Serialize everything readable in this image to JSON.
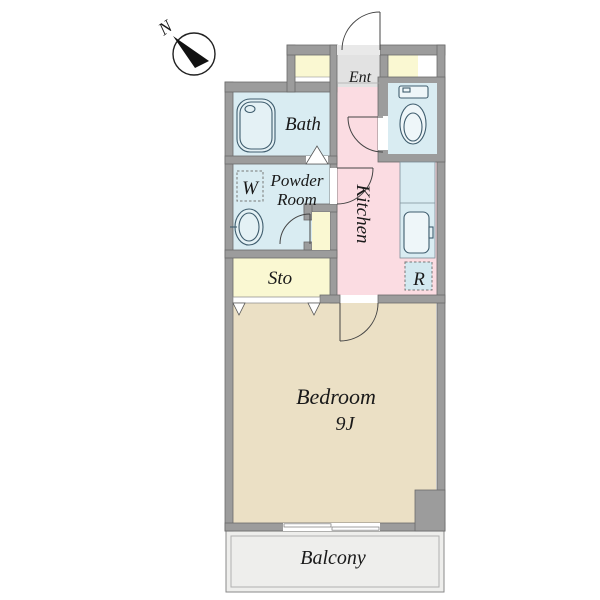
{
  "compass": {
    "north_label": "N"
  },
  "rooms": {
    "entrance": {
      "label": "Ent"
    },
    "bath": {
      "label": "Bath"
    },
    "powder_room": {
      "label_line1": "Powder",
      "label_line2": "Room"
    },
    "washing_machine": {
      "label": "W"
    },
    "storage": {
      "label": "Sto"
    },
    "kitchen": {
      "label": "Kitchen"
    },
    "refrigerator": {
      "label": "R"
    },
    "bedroom": {
      "label": "Bedroom",
      "size": "9J"
    },
    "balcony": {
      "label": "Balcony"
    }
  },
  "colors": {
    "wall": "#9c9c9c",
    "wet_area_blue": "#d9ecf2",
    "kitchen_pink": "#fbdce2",
    "closet_yellow": "#faf8d2",
    "bedroom_tan": "#ebe0c5",
    "entry_step_gray": "#e2e2e2",
    "balcony_gray": "#eeeeec",
    "fixture_line": "#3f5d6e"
  }
}
